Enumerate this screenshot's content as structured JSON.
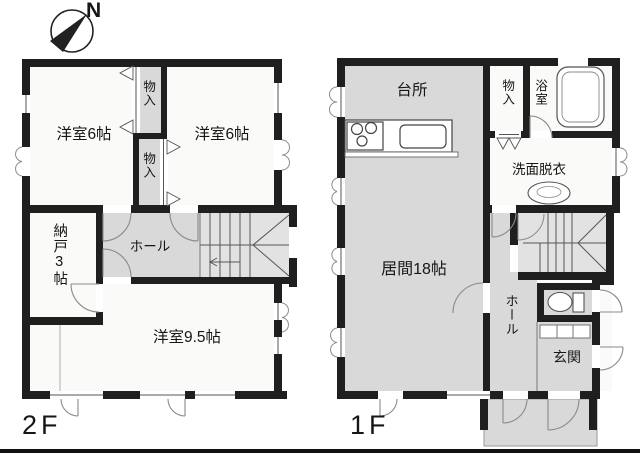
{
  "compass": {
    "north_label": "N"
  },
  "palette": {
    "wall": "#1f1f1f",
    "room_white": "#fafaf8",
    "room_gray": "#d9d9d9",
    "stair_gray": "#e2e2e2",
    "thin_line": "#555555",
    "door_arc": "#8a8a8a"
  },
  "floor2": {
    "label": "2F",
    "rooms": {
      "bedroom_left": "洋室6帖",
      "closet_upper": "物入",
      "closet_lower": "物入",
      "bedroom_right": "洋室6帖",
      "storage_room": "納戸3帖",
      "hall": "ホール",
      "bedroom_large": "洋室9.5帖"
    }
  },
  "floor1": {
    "label": "1F",
    "rooms": {
      "kitchen": "台所",
      "closet": "物入",
      "bathroom": "浴室",
      "washroom": "洗面脱衣",
      "living": "居間18帖",
      "hall": "ホール",
      "entrance": "玄関"
    }
  }
}
